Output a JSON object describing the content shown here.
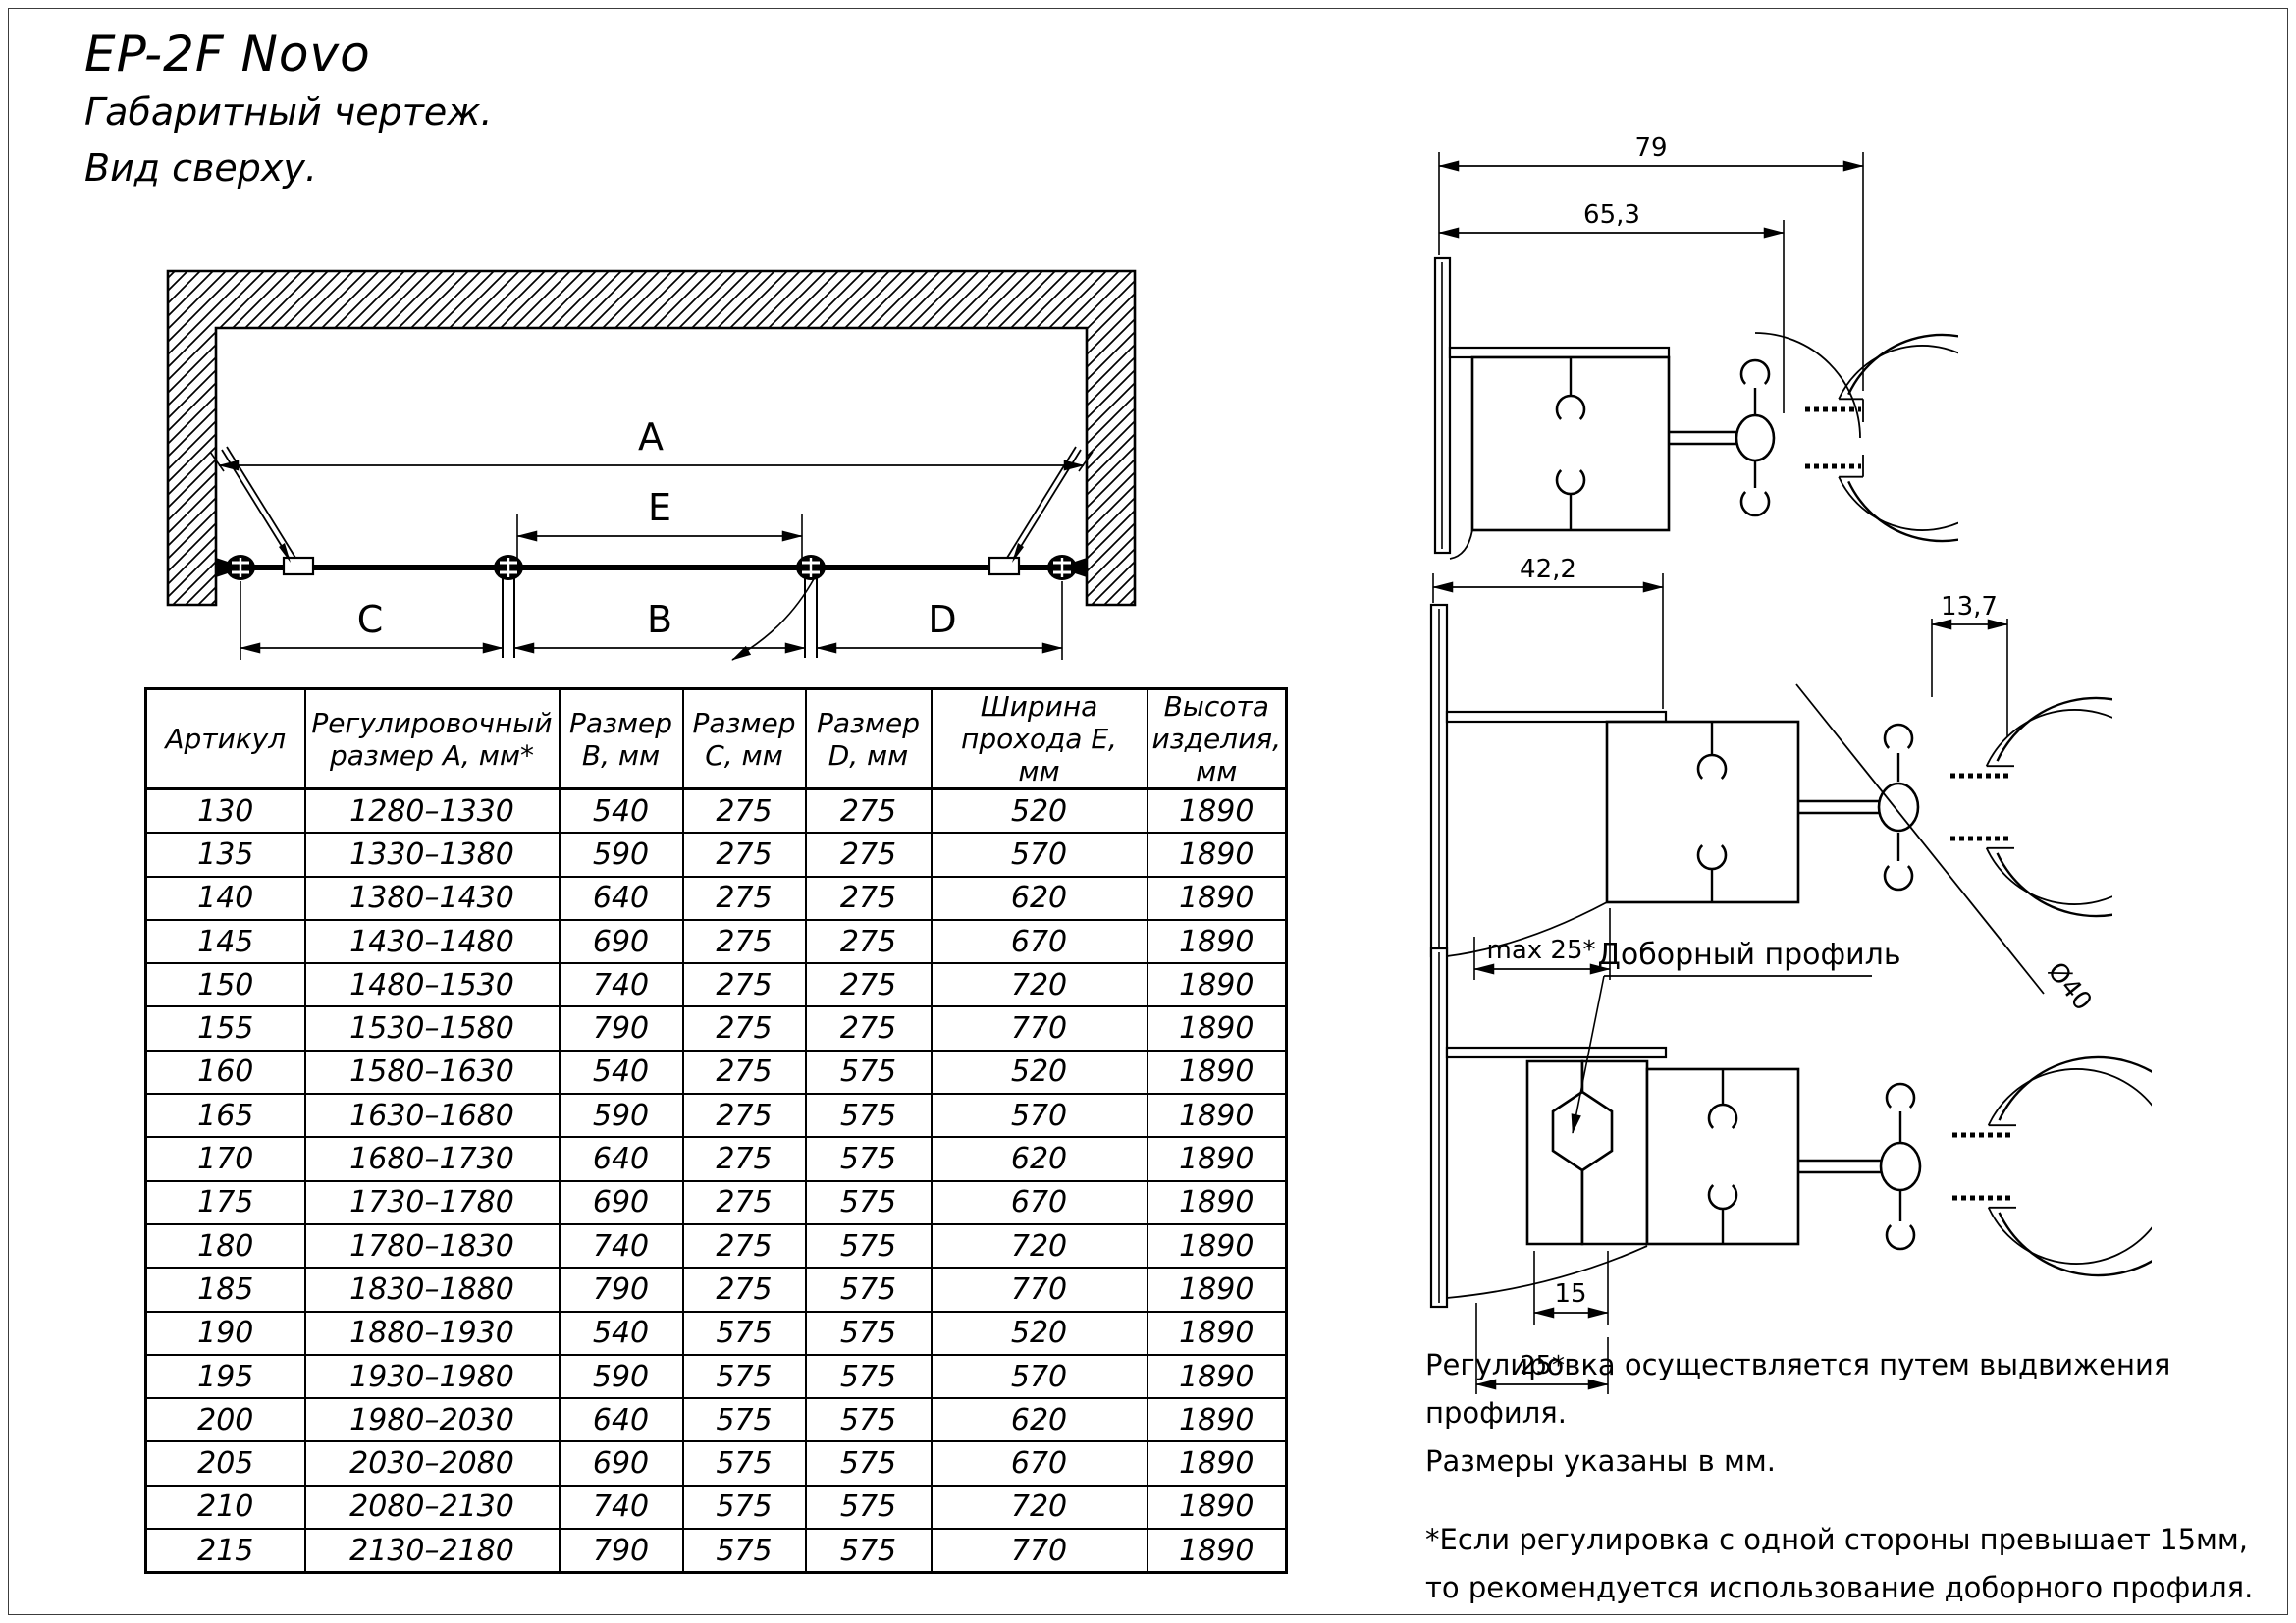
{
  "header": {
    "title": "EP-2F Novo",
    "subtitle1": "Габаритный чертеж.",
    "subtitle2": "Вид сверху."
  },
  "plan": {
    "dim_a": "A",
    "dim_e": "E",
    "dim_c": "C",
    "dim_b": "B",
    "dim_d": "D"
  },
  "profile_top": {
    "dim_width": "79",
    "dim_inner": "65,3"
  },
  "profile_middle": {
    "dim_width": "42,2",
    "dim_top": "13,7",
    "dim_max": "max 25*",
    "dim_diameter": "Ø40"
  },
  "profile_bottom": {
    "label": "Доборный профиль",
    "dim_inner": "15",
    "dim_outer": "25*"
  },
  "notes": {
    "line1": "Регулировка осуществляется путем выдвижения профиля.",
    "line2": "Размеры указаны в мм.",
    "line3": "*Если регулировка с одной стороны превышает 15мм,",
    "line4": "то рекомендуется использование доборного профиля."
  },
  "table": {
    "headers": [
      "Артикул",
      "Регулировочный размер А, мм*",
      "Размер B, мм",
      "Размер C, мм",
      "Размер D, мм",
      "Ширина прохода E, мм",
      "Высота изделия, мм"
    ],
    "rows": [
      [
        "130",
        "1280–1330",
        "540",
        "275",
        "275",
        "520",
        "1890"
      ],
      [
        "135",
        "1330–1380",
        "590",
        "275",
        "275",
        "570",
        "1890"
      ],
      [
        "140",
        "1380–1430",
        "640",
        "275",
        "275",
        "620",
        "1890"
      ],
      [
        "145",
        "1430–1480",
        "690",
        "275",
        "275",
        "670",
        "1890"
      ],
      [
        "150",
        "1480–1530",
        "740",
        "275",
        "275",
        "720",
        "1890"
      ],
      [
        "155",
        "1530–1580",
        "790",
        "275",
        "275",
        "770",
        "1890"
      ],
      [
        "160",
        "1580–1630",
        "540",
        "275",
        "575",
        "520",
        "1890"
      ],
      [
        "165",
        "1630–1680",
        "590",
        "275",
        "575",
        "570",
        "1890"
      ],
      [
        "170",
        "1680–1730",
        "640",
        "275",
        "575",
        "620",
        "1890"
      ],
      [
        "175",
        "1730–1780",
        "690",
        "275",
        "575",
        "670",
        "1890"
      ],
      [
        "180",
        "1780–1830",
        "740",
        "275",
        "575",
        "720",
        "1890"
      ],
      [
        "185",
        "1830–1880",
        "790",
        "275",
        "575",
        "770",
        "1890"
      ],
      [
        "190",
        "1880–1930",
        "540",
        "575",
        "575",
        "520",
        "1890"
      ],
      [
        "195",
        "1930–1980",
        "590",
        "575",
        "575",
        "570",
        "1890"
      ],
      [
        "200",
        "1980–2030",
        "640",
        "575",
        "575",
        "620",
        "1890"
      ],
      [
        "205",
        "2030–2080",
        "690",
        "575",
        "575",
        "670",
        "1890"
      ],
      [
        "210",
        "2080–2130",
        "740",
        "575",
        "575",
        "720",
        "1890"
      ],
      [
        "215",
        "2130–2180",
        "790",
        "575",
        "575",
        "770",
        "1890"
      ]
    ]
  }
}
